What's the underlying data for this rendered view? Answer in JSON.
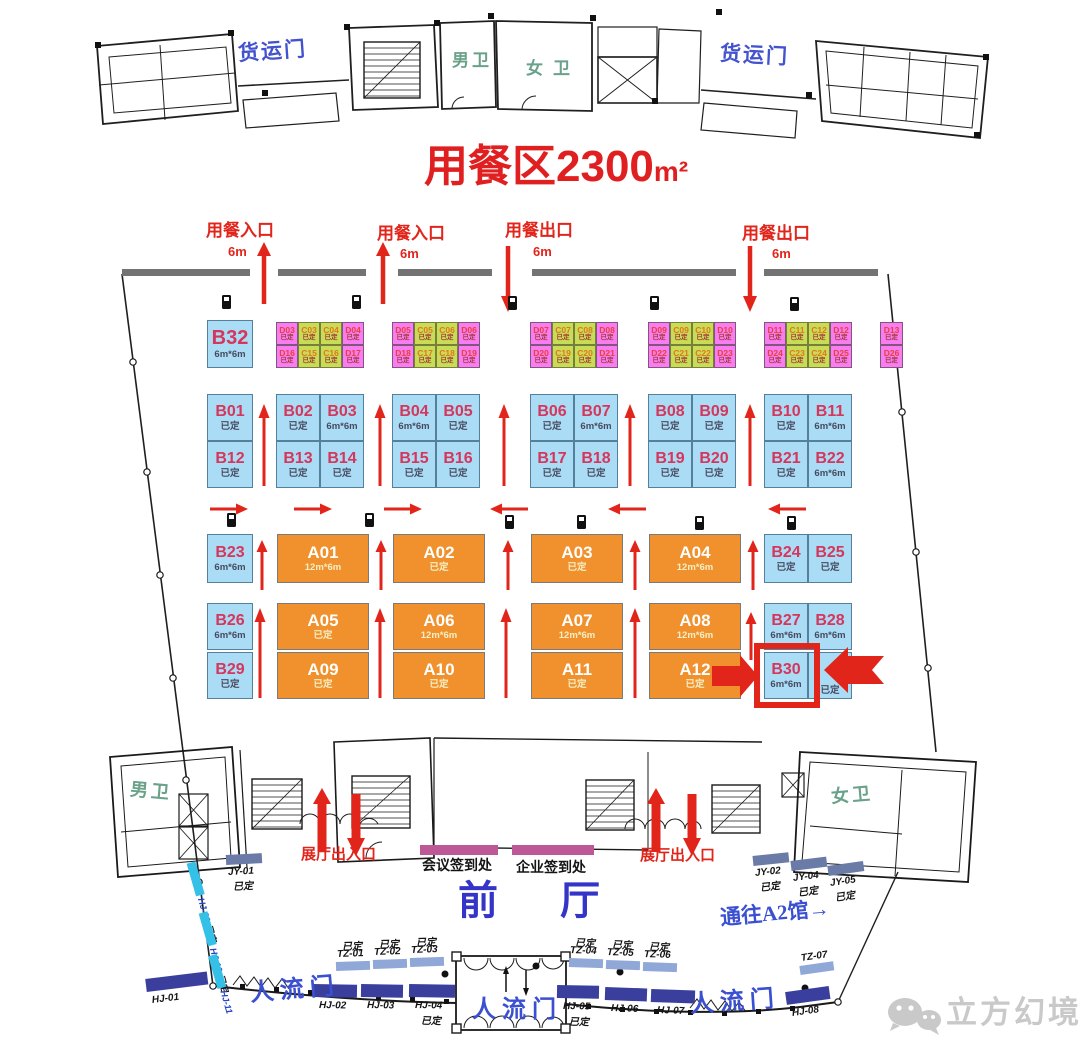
{
  "title": {
    "text": "用餐区2300",
    "unit": "m²"
  },
  "top_labels": {
    "freight_left": "货运门",
    "freight_right": "货运门",
    "mens_top": "男卫",
    "womens_top": "女卫",
    "mens_bottom": "男卫",
    "womens_bottom": "女卫"
  },
  "entrances": [
    {
      "label": "用餐入口",
      "size": "6m",
      "dir": "up",
      "lx": 206,
      "ly": 222,
      "sx": 228,
      "sy": 245,
      "ax": 264
    },
    {
      "label": "用餐入口",
      "size": "6m",
      "dir": "up",
      "lx": 377,
      "ly": 225,
      "sx": 400,
      "sy": 247,
      "ax": 383
    },
    {
      "label": "用餐出口",
      "size": "6m",
      "dir": "down",
      "lx": 505,
      "ly": 222,
      "sx": 533,
      "sy": 245,
      "ax": 508
    },
    {
      "label": "用餐出口",
      "size": "6m",
      "dir": "down",
      "lx": 742,
      "ly": 225,
      "sx": 772,
      "sy": 247,
      "ax": 750
    }
  ],
  "booths": {
    "blue": [
      {
        "id": "B32",
        "status": "6m*6m",
        "x": 207,
        "y": 320,
        "w": 46,
        "h": 48,
        "big": true
      },
      {
        "id": "B01",
        "status": "已定",
        "x": 207,
        "y": 394,
        "w": 46,
        "h": 47
      },
      {
        "id": "B12",
        "status": "已定",
        "x": 207,
        "y": 441,
        "w": 46,
        "h": 47
      },
      {
        "id": "B02",
        "status": "已定",
        "x": 276,
        "y": 394,
        "w": 44,
        "h": 47
      },
      {
        "id": "B03",
        "status": "6m*6m",
        "x": 320,
        "y": 394,
        "w": 44,
        "h": 47
      },
      {
        "id": "B13",
        "status": "已定",
        "x": 276,
        "y": 441,
        "w": 44,
        "h": 47
      },
      {
        "id": "B14",
        "status": "已定",
        "x": 320,
        "y": 441,
        "w": 44,
        "h": 47
      },
      {
        "id": "B04",
        "status": "6m*6m",
        "x": 392,
        "y": 394,
        "w": 44,
        "h": 47
      },
      {
        "id": "B05",
        "status": "已定",
        "x": 436,
        "y": 394,
        "w": 44,
        "h": 47
      },
      {
        "id": "B15",
        "status": "已定",
        "x": 392,
        "y": 441,
        "w": 44,
        "h": 47
      },
      {
        "id": "B16",
        "status": "已定",
        "x": 436,
        "y": 441,
        "w": 44,
        "h": 47
      },
      {
        "id": "B06",
        "status": "已定",
        "x": 530,
        "y": 394,
        "w": 44,
        "h": 47
      },
      {
        "id": "B07",
        "status": "6m*6m",
        "x": 574,
        "y": 394,
        "w": 44,
        "h": 47
      },
      {
        "id": "B17",
        "status": "已定",
        "x": 530,
        "y": 441,
        "w": 44,
        "h": 47
      },
      {
        "id": "B18",
        "status": "已定",
        "x": 574,
        "y": 441,
        "w": 44,
        "h": 47
      },
      {
        "id": "B08",
        "status": "已定",
        "x": 648,
        "y": 394,
        "w": 44,
        "h": 47
      },
      {
        "id": "B09",
        "status": "已定",
        "x": 692,
        "y": 394,
        "w": 44,
        "h": 47
      },
      {
        "id": "B19",
        "status": "已定",
        "x": 648,
        "y": 441,
        "w": 44,
        "h": 47
      },
      {
        "id": "B20",
        "status": "已定",
        "x": 692,
        "y": 441,
        "w": 44,
        "h": 47
      },
      {
        "id": "B10",
        "status": "已定",
        "x": 764,
        "y": 394,
        "w": 44,
        "h": 47
      },
      {
        "id": "B11",
        "status": "6m*6m",
        "x": 808,
        "y": 394,
        "w": 44,
        "h": 47
      },
      {
        "id": "B21",
        "status": "已定",
        "x": 764,
        "y": 441,
        "w": 44,
        "h": 47
      },
      {
        "id": "B22",
        "status": "6m*6m",
        "x": 808,
        "y": 441,
        "w": 44,
        "h": 47
      },
      {
        "id": "B23",
        "status": "6m*6m",
        "x": 207,
        "y": 534,
        "w": 46,
        "h": 49
      },
      {
        "id": "B24",
        "status": "已定",
        "x": 764,
        "y": 534,
        "w": 44,
        "h": 49
      },
      {
        "id": "B25",
        "status": "已定",
        "x": 808,
        "y": 534,
        "w": 44,
        "h": 49
      },
      {
        "id": "B26",
        "status": "6m*6m",
        "x": 207,
        "y": 603,
        "w": 46,
        "h": 47
      },
      {
        "id": "B29",
        "status": "已定",
        "x": 207,
        "y": 652,
        "w": 46,
        "h": 47
      },
      {
        "id": "B27",
        "status": "6m*6m",
        "x": 764,
        "y": 603,
        "w": 44,
        "h": 47
      },
      {
        "id": "B28",
        "status": "6m*6m",
        "x": 808,
        "y": 603,
        "w": 44,
        "h": 47
      },
      {
        "id": "B30",
        "status": "6m*6m",
        "x": 764,
        "y": 652,
        "w": 44,
        "h": 47,
        "highlight": true
      },
      {
        "id": "",
        "status": "已定",
        "x": 808,
        "y": 652,
        "w": 44,
        "h": 47,
        "covered": true
      }
    ],
    "orange": [
      {
        "id": "A01",
        "status": "12m*6m",
        "x": 277,
        "y": 534,
        "w": 92,
        "h": 49
      },
      {
        "id": "A02",
        "status": "已定",
        "x": 393,
        "y": 534,
        "w": 92,
        "h": 49
      },
      {
        "id": "A03",
        "status": "已定",
        "x": 531,
        "y": 534,
        "w": 92,
        "h": 49
      },
      {
        "id": "A04",
        "status": "12m*6m",
        "x": 649,
        "y": 534,
        "w": 92,
        "h": 49
      },
      {
        "id": "A05",
        "status": "已定",
        "x": 277,
        "y": 603,
        "w": 92,
        "h": 47
      },
      {
        "id": "A06",
        "status": "12m*6m",
        "x": 393,
        "y": 603,
        "w": 92,
        "h": 47
      },
      {
        "id": "A07",
        "status": "12m*6m",
        "x": 531,
        "y": 603,
        "w": 92,
        "h": 47
      },
      {
        "id": "A08",
        "status": "12m*6m",
        "x": 649,
        "y": 603,
        "w": 92,
        "h": 47
      },
      {
        "id": "A09",
        "status": "已定",
        "x": 277,
        "y": 652,
        "w": 92,
        "h": 47
      },
      {
        "id": "A10",
        "status": "已定",
        "x": 393,
        "y": 652,
        "w": 92,
        "h": 47
      },
      {
        "id": "A11",
        "status": "已定",
        "x": 531,
        "y": 652,
        "w": 92,
        "h": 47
      },
      {
        "id": "A12",
        "status": "已定",
        "x": 649,
        "y": 652,
        "w": 92,
        "h": 47
      }
    ],
    "cell_groups": [
      {
        "x": 276,
        "w": 22,
        "rows": [
          [
            "D03",
            "C03",
            "C04",
            "D04"
          ],
          [
            "D16",
            "C15",
            "C16",
            "D17"
          ]
        ]
      },
      {
        "x": 392,
        "w": 22,
        "rows": [
          [
            "D05",
            "C05",
            "C06",
            "D06"
          ],
          [
            "D18",
            "C17",
            "C18",
            "D19"
          ]
        ]
      },
      {
        "x": 530,
        "w": 22,
        "rows": [
          [
            "D07",
            "C07",
            "C08",
            "D08"
          ],
          [
            "D20",
            "C19",
            "C20",
            "D21"
          ]
        ]
      },
      {
        "x": 648,
        "w": 22,
        "rows": [
          [
            "D09",
            "C09",
            "C10",
            "D10"
          ],
          [
            "D22",
            "C21",
            "C22",
            "D23"
          ]
        ]
      },
      {
        "x": 764,
        "w": 22,
        "rows": [
          [
            "D11",
            "C11",
            "C12",
            "D12"
          ],
          [
            "D24",
            "C23",
            "C24",
            "D25"
          ]
        ]
      },
      {
        "x": 880,
        "w": 23,
        "rows": [
          [
            "D13"
          ],
          [
            "D26"
          ]
        ]
      }
    ],
    "cell_status": "已定"
  },
  "exits": [
    {
      "label": "展厅出入口",
      "x": 301,
      "y": 847,
      "up": 322,
      "down": 356
    },
    {
      "label": "展厅出入口",
      "x": 640,
      "y": 848,
      "up": 656,
      "down": 692
    }
  ],
  "desks": [
    {
      "label": "会议签到处",
      "bx": 420,
      "by": 845,
      "bw": 78,
      "tx": 422,
      "ty": 858
    },
    {
      "label": "企业签到处",
      "bx": 512,
      "by": 845,
      "bw": 82,
      "tx": 516,
      "ty": 860
    }
  ],
  "doors": {
    "jy": [
      {
        "id": "JY-01",
        "status": "已定",
        "x": 226,
        "y": 855,
        "rot": -3
      },
      {
        "id": "JY-02",
        "status": "已定",
        "x": 753,
        "y": 856,
        "rot": -6
      },
      {
        "id": "JY-04",
        "status": "已定",
        "x": 791,
        "y": 861,
        "rot": -7
      },
      {
        "id": "JY-05",
        "status": "已定",
        "x": 828,
        "y": 866,
        "rot": -8
      }
    ],
    "tz": [
      {
        "id": "TZ-01",
        "status": "已定",
        "x": 336,
        "y": 962,
        "rot": -2
      },
      {
        "id": "TZ-02",
        "status": "已定",
        "x": 373,
        "y": 960,
        "rot": -2
      },
      {
        "id": "TZ-03",
        "status": "已定",
        "x": 410,
        "y": 958,
        "rot": -2
      },
      {
        "id": "TZ-04",
        "status": "已定",
        "x": 569,
        "y": 958,
        "rot": 2
      },
      {
        "id": "TZ-05",
        "status": "已定",
        "x": 606,
        "y": 960,
        "rot": 2
      },
      {
        "id": "TZ-06",
        "status": "已定",
        "x": 643,
        "y": 962,
        "rot": 2
      },
      {
        "id": "TZ-07",
        "status": "",
        "x": 800,
        "y": 966,
        "rot": -8
      }
    ],
    "hj": [
      {
        "id": "HJ-01",
        "status": "",
        "x": 146,
        "y": 979,
        "rot": -7,
        "w": 62
      },
      {
        "id": "HJ-02",
        "status": "",
        "x": 313,
        "y": 984,
        "rot": 1,
        "w": 44
      },
      {
        "id": "HJ-03",
        "status": "",
        "x": 361,
        "y": 984,
        "rot": 1,
        "w": 42
      },
      {
        "id": "HJ-04",
        "status": "已定",
        "x": 409,
        "y": 984,
        "rot": 1,
        "w": 46
      },
      {
        "id": "HJ-05",
        "status": "已定",
        "x": 557,
        "y": 985,
        "rot": 1,
        "w": 42
      },
      {
        "id": "HJ-06",
        "status": "",
        "x": 605,
        "y": 987,
        "rot": 2,
        "w": 42
      },
      {
        "id": "HJ-07",
        "status": "",
        "x": 651,
        "y": 989,
        "rot": 2,
        "w": 44
      },
      {
        "id": "HJ-08",
        "status": "",
        "x": 786,
        "y": 992,
        "rot": -8,
        "w": 44
      }
    ],
    "hj_side": [
      {
        "id": "HJ-09",
        "status": "已定",
        "x": 191,
        "y": 856,
        "rot": 74
      },
      {
        "id": "HJ-10",
        "status": "已定",
        "x": 203,
        "y": 906,
        "rot": 74
      },
      {
        "id": "HJ-11",
        "status": "",
        "x": 213,
        "y": 950,
        "rot": 74
      }
    ]
  },
  "people_doors": [
    {
      "label": "人流门",
      "x": 250,
      "y": 978,
      "rot": -5
    },
    {
      "label": "人流门",
      "x": 472,
      "y": 998,
      "rot": 0
    },
    {
      "label": "人流门",
      "x": 690,
      "y": 990,
      "rot": -4
    }
  ],
  "hall": {
    "label": "前厅",
    "x": 458,
    "y": 880
  },
  "passage": {
    "label": "通往A2馆→",
    "x": 720,
    "y": 902
  },
  "logo": {
    "label": "立方幻境",
    "x": 946,
    "y": 997
  },
  "colors": {
    "booth_blue": "#ABDCF5",
    "booth_orange": "#F0912D",
    "cell_pink": "#F97DF0",
    "cell_green": "#C9DC55",
    "booth_label_red": "#D5365C",
    "arrow_red": "#E1251B",
    "blue_text": "#3A50D0",
    "green_text": "#69A189",
    "wall_gray": "#737373",
    "sign_magenta": "#BE5796",
    "bar_slate": "#6B7BA8",
    "bar_light": "#8FA8D8",
    "bar_dark": "#3A3F9E",
    "bar_cyan": "#35C0E8",
    "logo_gray": "#C9C9C9"
  }
}
